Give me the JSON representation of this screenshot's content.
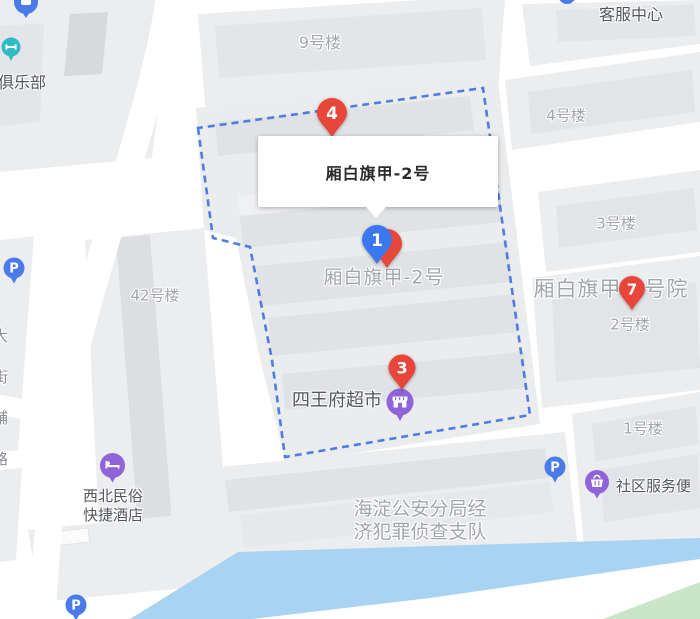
{
  "popup": {
    "title": "厢白旗甲-2号"
  },
  "markers": {
    "m1": {
      "number": "1"
    },
    "m3": {
      "number": "3"
    },
    "m4": {
      "number": "4"
    },
    "m7": {
      "number": "7"
    }
  },
  "labels": {
    "building9": "9号楼",
    "building4": "4号楼",
    "building3": "3号楼",
    "building2": "2号楼",
    "building1": "1号楼",
    "building42": "42号楼",
    "service_center": "客服中心",
    "club": "俱乐部",
    "compound": "厢白旗甲-2号院",
    "address": "厢白旗甲-2号",
    "supermarket": "四王府超市",
    "hotel_line1": "西北民俗",
    "hotel_line2": "快捷酒店",
    "police_line1": "海淀公安分局经",
    "police_line2": "济犯罪侦查支队",
    "community_service": "社区服务便",
    "road": "大街辅路",
    "parking": "P"
  },
  "colors": {
    "marker_red": "#e8463a",
    "marker_blue": "#3b78ef",
    "poi_purple": "#8f64d8",
    "poi_teal": "#2fbac6",
    "parking_blue": "#4b7be8",
    "boundary_blue": "#4273dd",
    "river_blue": "#a8d3f2",
    "park_green": "#c9e6c8",
    "block_gray": "#ecedef",
    "building_gray": "#e2e4e7",
    "building_label_gray": "#a2a5ab",
    "poi_label_dark": "#53565b"
  }
}
